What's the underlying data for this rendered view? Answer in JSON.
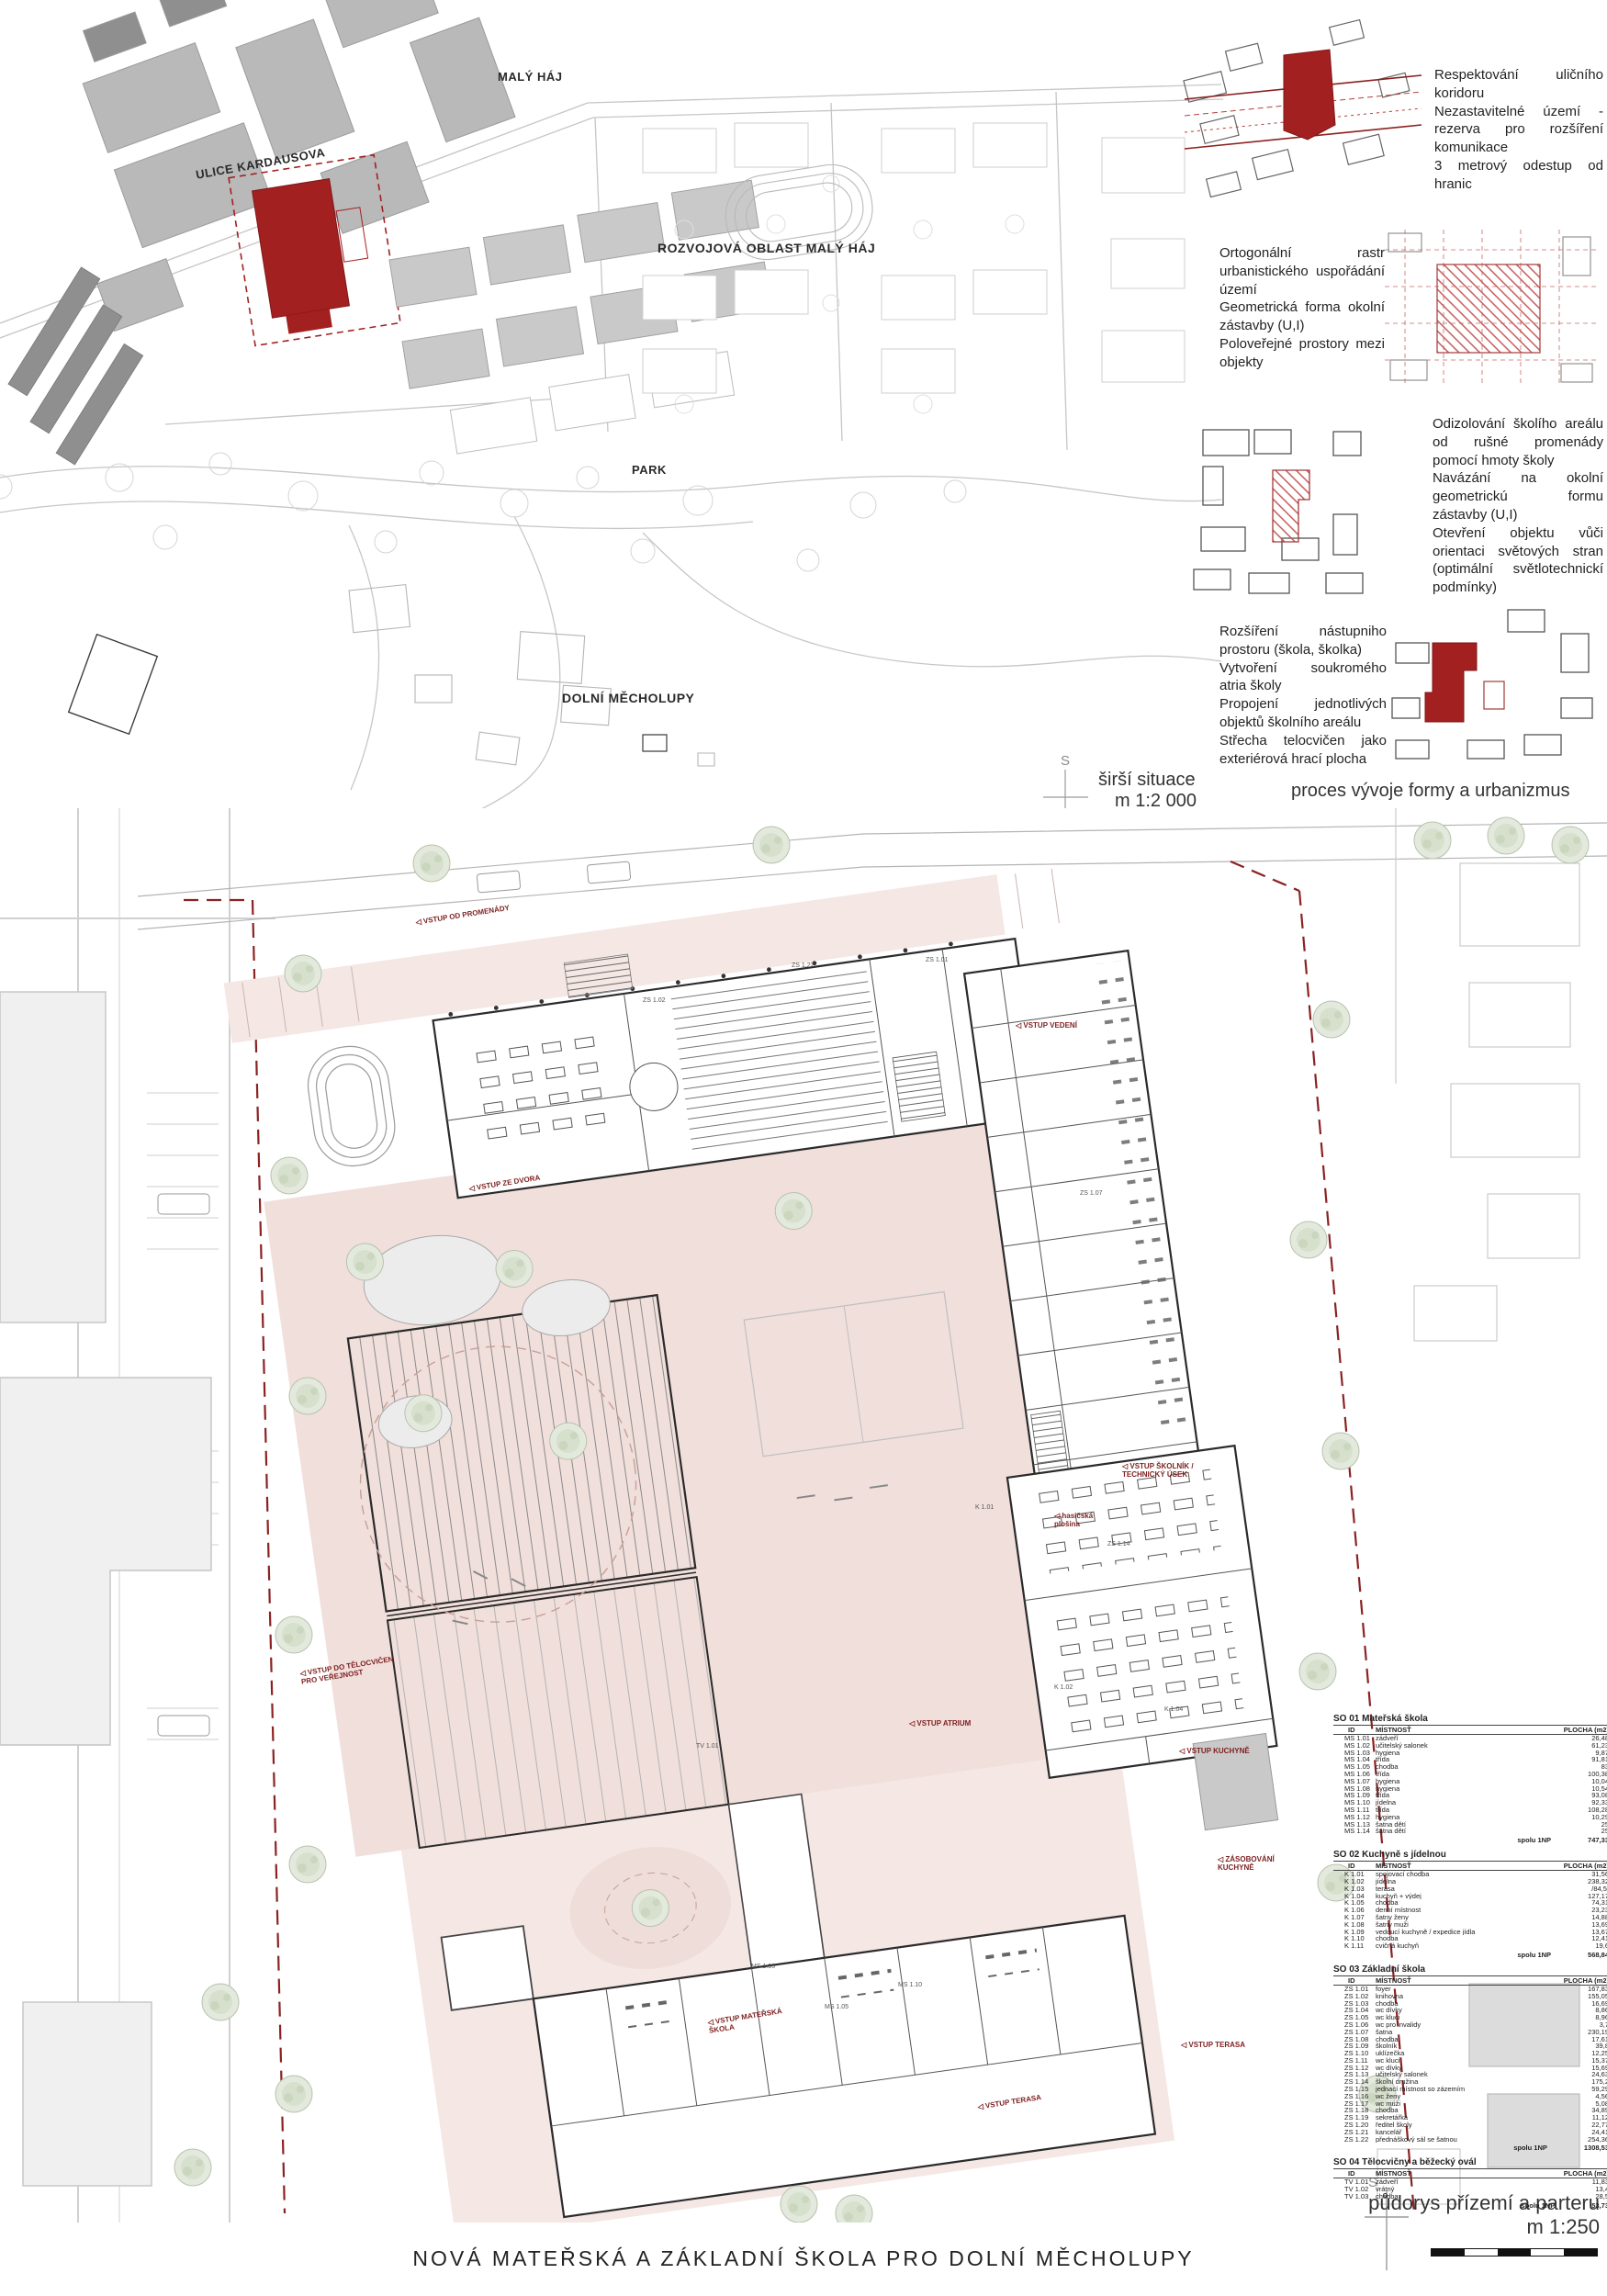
{
  "board": {
    "title": "NOVÁ MATEŘSKÁ A ZÁKLADNÍ ŠKOLA PRO DOLNÍ MĚCHOLUPY"
  },
  "site_plan": {
    "labels": {
      "maly_haj": "MALÝ HÁJ",
      "ulice_kardausova": "ULICE KARDAUSOVA",
      "rozvojova_oblast": "ROZVOJOVÁ OBLAST MALÝ HÁJ",
      "park": "PARK",
      "dolni_mecholupy": "DOLNÍ MĚCHOLUPY"
    },
    "caption_line1": "širší situace",
    "caption_line2": "m 1:2 000",
    "north_label": "S"
  },
  "process": {
    "caption": "proces vývoje formy a urbanizmus",
    "steps": [
      {
        "text": "Respektování uličního koridoru\nNezastavitelné území - rezerva pro rozšíření komunikace\n3 metrový odestup od hranic"
      },
      {
        "text": "Ortogonální rastr urbanistického uspořádání území\nGeometrická forma okolní zástavby (U,I)\nPoloveřejné prostory mezi objekty"
      },
      {
        "text": "Odizolování školího areálu od rušné promenády pomocí hmoty školy\nNavázání na okolní geometrickú formu zástavby (U,I)\nOtevření objektu vůči orientaci světových stran (optimální světlotechnickí podmínky)"
      },
      {
        "text": "Rozšíření nástupniho prostoru (škola, školka)\nVytvoření soukromého atria školy\nPropojení jednotlivých objektů školního areálu\nStřecha telocvičen jako exteriérová hrací plocha"
      }
    ]
  },
  "floor_plan": {
    "caption_line1": "půdorys přízemí a parteru",
    "caption_line2": "m 1:250",
    "north_label": "S",
    "entrance_labels": [
      "VSTUP OD PROMENÁDY",
      "VSTUP VEDENÍ",
      "VSTUP ZE DVORA",
      "VSTUP ŠKOLNÍK /\nTECHNICKÝ ÚSEK",
      "hasičská\nplošina",
      "VSTUP DO TĚLOCVIČEN\nPRO VEŘEJNOST",
      "VSTUP ATRIUM",
      "VSTUP KUCHYNĚ",
      "ZÁSOBOVÁNÍ\nKUCHYNĚ",
      "VSTUP MATEŘSKÁ\nŠKOLA",
      "VSTUP TERASA",
      "VSTUP TERASA"
    ],
    "room_codes": [
      "ZS 1.22",
      "ZS 1.01",
      "ZS 1.02",
      "ZS 1.07",
      "ZS 1.14",
      "K 1.01",
      "K 1.02",
      "K 1.04",
      "MS 1.05",
      "MS 1.06",
      "MS 1.10",
      "TV 1.01"
    ]
  },
  "tables": [
    {
      "title": "SO 01 Mateřská škola",
      "columns": [
        "ID",
        "MÍSTNOSŤ",
        "PLOCHA (m2)"
      ],
      "rows": [
        [
          "MS 1.01",
          "zádveří",
          "26,48"
        ],
        [
          "MS 1.02",
          "učitelský salonek",
          "61,23"
        ],
        [
          "MS 1.03",
          "hygiena",
          "9,87"
        ],
        [
          "MS 1.04",
          "třída",
          "91,81"
        ],
        [
          "MS 1.05",
          "chodba",
          "83"
        ],
        [
          "MS 1.06",
          "třída",
          "100,38"
        ],
        [
          "MS 1.07",
          "hygiena",
          "10,04"
        ],
        [
          "MS 1.08",
          "hygiena",
          "10,54"
        ],
        [
          "MS 1.09",
          "třída",
          "93,08"
        ],
        [
          "MS 1.10",
          "jídelna",
          "92,33"
        ],
        [
          "MS 1.11",
          "třída",
          "108,28"
        ],
        [
          "MS 1.12",
          "hygiena",
          "10,29"
        ],
        [
          "MS 1.13",
          "šatna dětí",
          "25"
        ],
        [
          "MS 1.14",
          "šatna dětí",
          "25"
        ]
      ],
      "total_label": "spolu 1NP",
      "total": "747,33"
    },
    {
      "title": "SO 02 Kuchyně s jídelnou",
      "columns": [
        "ID",
        "MÍSTNOSŤ",
        "PLOCHA (m2)"
      ],
      "rows": [
        [
          "K 1.01",
          "spojovací chodba",
          "31,56"
        ],
        [
          "K 1.02",
          "jídelna",
          "238,32"
        ],
        [
          "K 1.03",
          "terasa",
          "/84,5/"
        ],
        [
          "K 1.04",
          "kuchyň + výdej",
          "127,17"
        ],
        [
          "K 1.05",
          "chodba",
          "74,31"
        ],
        [
          "K 1.06",
          "denní místnost",
          "23,23"
        ],
        [
          "K 1.07",
          "šatny ženy",
          "14,88"
        ],
        [
          "K 1.08",
          "šatny muži",
          "13,69"
        ],
        [
          "K 1.09",
          "vedoucí kuchyně / expedice jídla",
          "13,67"
        ],
        [
          "K 1.10",
          "chodba",
          "12,41"
        ],
        [
          "K 1.11",
          "cvičná kuchyň",
          "19,6"
        ]
      ],
      "total_label": "spolu 1NP",
      "total": "568,84"
    },
    {
      "title": "SO 03 Základní škola",
      "columns": [
        "ID",
        "MÍSTNOSŤ",
        "PLOCHA (m2)"
      ],
      "rows": [
        [
          "ZS 1.01",
          "foyer",
          "167,83"
        ],
        [
          "ZS 1.02",
          "knihovna",
          "155,05"
        ],
        [
          "ZS 1.03",
          "chodba",
          "16,69"
        ],
        [
          "ZS 1.04",
          "wc dívky",
          "8,86"
        ],
        [
          "ZS 1.05",
          "wc kluci",
          "8,96"
        ],
        [
          "ZS 1.06",
          "wc pro invalidy",
          "3,7"
        ],
        [
          "ZS 1.07",
          "šatna",
          "230,19"
        ],
        [
          "ZS 1.08",
          "chodba",
          "17,61"
        ],
        [
          "ZS 1.09",
          "školník",
          "39,8"
        ],
        [
          "ZS 1.10",
          "uklízečka",
          "12,25"
        ],
        [
          "ZS 1.11",
          "wc kluci",
          "15,37"
        ],
        [
          "ZS 1.12",
          "wc dívky",
          "15,69"
        ],
        [
          "ZS 1.13",
          "učitelský salonek",
          "24,63"
        ],
        [
          "ZS 1.14",
          "školní družina",
          "175,2"
        ],
        [
          "ZS 1.15",
          "jednací místnost so zázemím",
          "59,29"
        ],
        [
          "ZS 1.16",
          "wc ženy",
          "4,56"
        ],
        [
          "ZS 1.17",
          "wc muži",
          "5,08"
        ],
        [
          "ZS 1.18",
          "chodba",
          "34,89"
        ],
        [
          "ZS 1.19",
          "sekretářka",
          "11,12"
        ],
        [
          "ZS 1.20",
          "ředitel školy",
          "22,77"
        ],
        [
          "ZS 1.21",
          "kancelář",
          "24,41"
        ],
        [
          "ZS 1.22",
          "přednáškový sál se šatnou",
          "254,36"
        ]
      ],
      "total_label": "spolu 1NP",
      "total": "1308,53"
    },
    {
      "title": "SO 04 Tělocvičny a běžecký ovál",
      "columns": [
        "ID",
        "MÍSTNOSŤ",
        "PLOCHA (m2)"
      ],
      "rows": [
        [
          "TV 1.01",
          "zádveří",
          "11,83"
        ],
        [
          "TV 1.02",
          "vrátný",
          "13,4"
        ],
        [
          "TV 1.03",
          "chodba",
          "28,5"
        ]
      ],
      "total_label": "spolu 1NP",
      "total": "53,73"
    }
  ]
}
